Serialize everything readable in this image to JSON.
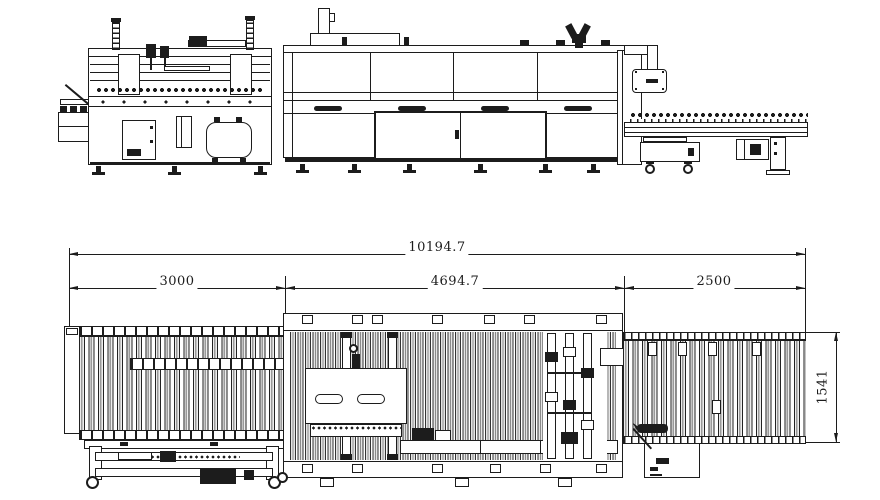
{
  "drawing": {
    "dimensions": {
      "total_length": "10194.7",
      "infeed_length": "3000",
      "center_length": "4694.7",
      "outfeed_length": "2500",
      "line_width": "1541"
    },
    "colors": {
      "line": "#1c1c1c",
      "background": "#ffffff"
    }
  }
}
